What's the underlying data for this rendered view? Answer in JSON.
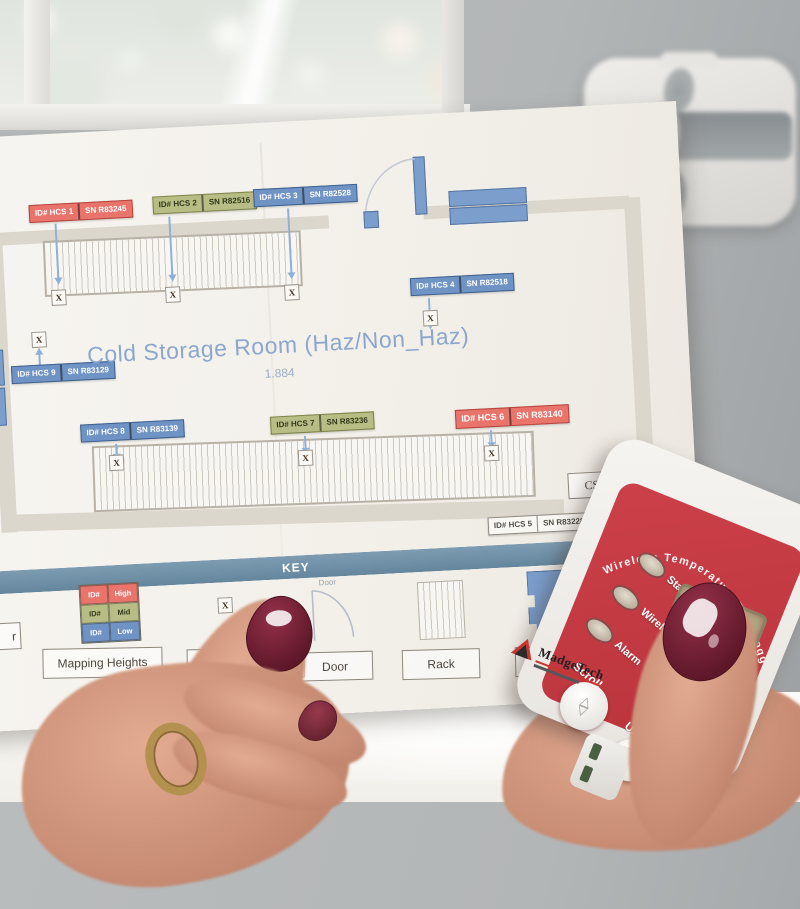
{
  "plan": {
    "title": "Cold Storage Room (Haz/Non_Haz)",
    "subtitle": "1.884",
    "marker": "X",
    "cs_label": "CS",
    "sensors": [
      {
        "id": "ID# HCS 1",
        "sn": "SN R83245",
        "level": "high"
      },
      {
        "id": "ID# HCS 2",
        "sn": "SN R82516",
        "level": "mid"
      },
      {
        "id": "ID# HCS 3",
        "sn": "SN R82528",
        "level": "low"
      },
      {
        "id": "ID# HCS 4",
        "sn": "SN R82518",
        "level": "low"
      },
      {
        "id": "ID# HCS 5",
        "sn": "SN R83228",
        "level": "plain"
      },
      {
        "id": "ID# HCS 6",
        "sn": "SN R83140",
        "level": "high"
      },
      {
        "id": "ID# HCS 7",
        "sn": "SN R83236",
        "level": "mid"
      },
      {
        "id": "ID# HCS 8",
        "sn": "SN R83139",
        "level": "low"
      },
      {
        "id": "ID# HCS 9",
        "sn": "SN R83129",
        "level": "low"
      }
    ],
    "key": {
      "header": "KEY",
      "height_rows": [
        {
          "id": "ID#",
          "label": "High"
        },
        {
          "id": "ID#",
          "label": "Mid"
        },
        {
          "id": "ID#",
          "label": "Low"
        }
      ],
      "mapping_heights_label": "Mapping Heights",
      "mapping_partial_label": "Man",
      "edge_partial_label": "r",
      "door_glyph_label": "Door",
      "door_label": "Door",
      "rack_label": "Rack",
      "chiller_label": "Chiller"
    }
  },
  "device": {
    "arc_text": "Wireless Temperature Data Logger",
    "led_labels": [
      "Status",
      "Wireless",
      "Alarm"
    ],
    "scroll_label": "Scroll",
    "units_label": "Units",
    "units_glyph_c": "°C",
    "units_glyph_f": "°F",
    "scroll_up_glyph": "△",
    "scroll_down_glyph": "▽",
    "brand": "MadgeTech",
    "body_partial_text": "M"
  },
  "colors": {
    "sensor_high": "#e8746b",
    "sensor_mid": "#b7bd85",
    "sensor_low": "#6f93c4",
    "key_bar": "#6d8da4",
    "device_red": "#c23a41",
    "lcd": "#b3a181",
    "arrow": "#8fb0d8",
    "wall_band": "#dcd7cc"
  }
}
